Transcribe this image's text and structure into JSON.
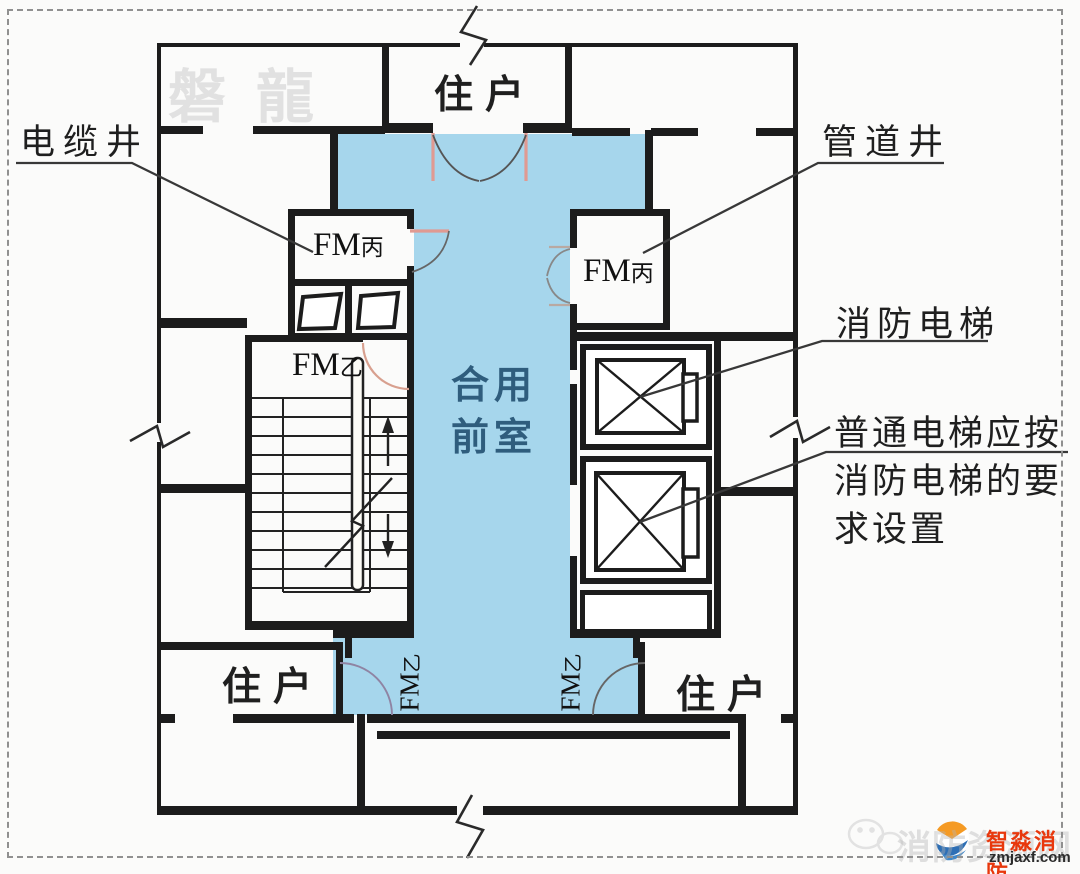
{
  "colors": {
    "front_room_fill": "#a6d6ec",
    "front_room_text": "#2f5d7d",
    "wall": "#1c1c1c",
    "door_leaf_pink": "#e09a92",
    "brand_red": "#e8380d",
    "brand_orange": "#f59a23",
    "brand_blue": "#2e6fb5"
  },
  "watermarks": {
    "top_left": "磐龍",
    "bottom_right": "消防资源网"
  },
  "logo": {
    "brand": "智淼消防",
    "site": "zmjaxf.com"
  },
  "rooms": {
    "front_room": {
      "line1": "合用",
      "line2": "前室"
    },
    "resident_top": "住户",
    "resident_bottom_left": "住户",
    "resident_bottom_right": "住户"
  },
  "annotations": {
    "cable_shaft": "电缆井",
    "pipe_shaft": "管道井",
    "fire_elevator": "消防电梯",
    "ordinary_elevator": {
      "line1": "普通电梯应按",
      "line2": "消防电梯的要",
      "line3": "求设置"
    }
  },
  "door_labels": {
    "fm_bing": {
      "main": "FM",
      "sub": "丙"
    },
    "fm_yi": {
      "main": "FM",
      "sub": "乙"
    }
  }
}
